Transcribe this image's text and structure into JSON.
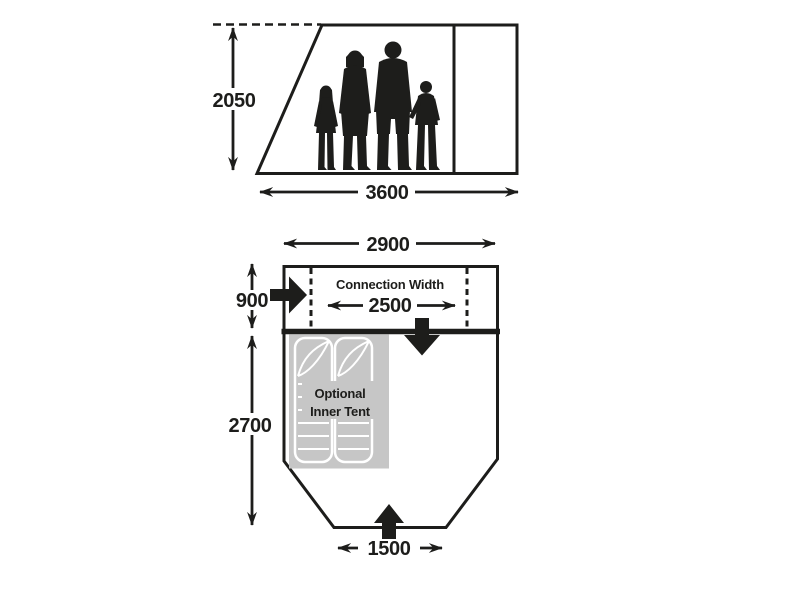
{
  "side_view": {
    "height_label": "2050",
    "width_label": "3600"
  },
  "floor_plan": {
    "total_width_label": "2900",
    "connection_depth_label": "900",
    "connection_width_title": "Connection Width",
    "connection_width_label": "2500",
    "main_depth_label": "2700",
    "inner_tent_label_line1": "Optional",
    "inner_tent_label_line2": "Inner Tent",
    "front_door_width_label": "1500"
  },
  "icons": {
    "family": "family-silhouette",
    "side_door": "solid-arrow-right",
    "connection_door": "solid-arrow-down",
    "front_door": "solid-arrow-up",
    "inner_tent": "sleeping-bags"
  },
  "colors": {
    "line": "#1d1d1b",
    "background": "#ffffff",
    "inner_tent_fill": "#c6c6c6",
    "sleeping_bag_outline": "#ffffff"
  }
}
